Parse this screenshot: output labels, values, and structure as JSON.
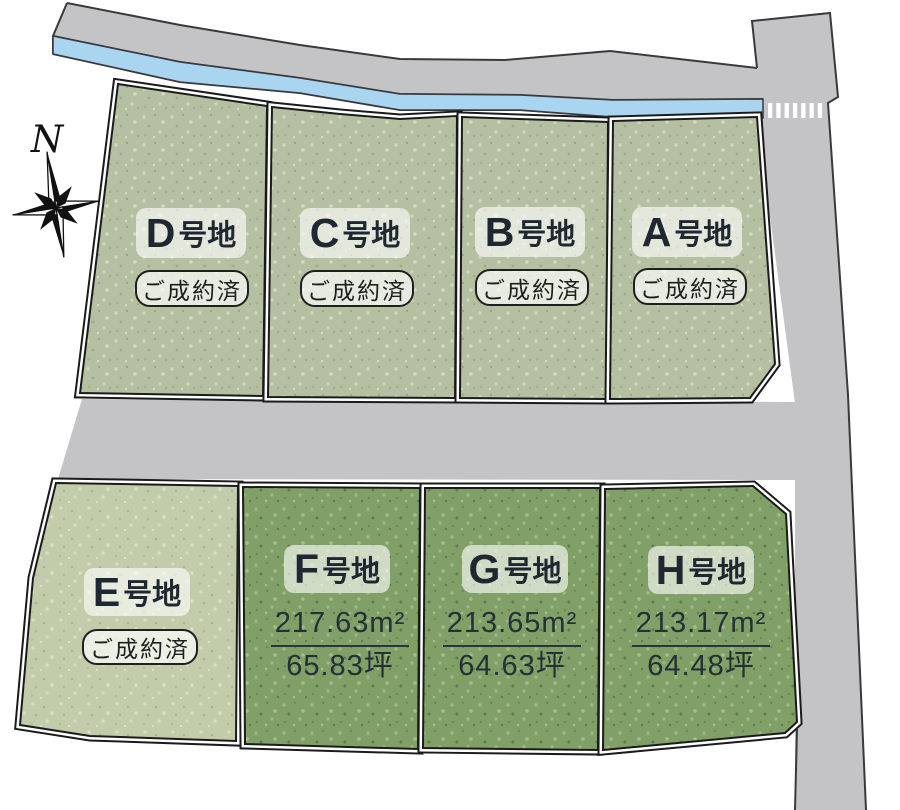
{
  "compass": {
    "label": "N"
  },
  "colors": {
    "road": "#c4c4c6",
    "road_edge": "#3a3a3d",
    "stream": "#aad5f0",
    "crosswalk": "#ffffff",
    "plot_outline": "#1b1b1b",
    "plot_sage": "#b5bfa2",
    "plot_pale": "#c2ccab",
    "plot_green": "#80a067",
    "label_text": "#1f2730"
  },
  "plots": [
    {
      "id": "D",
      "letter": "D",
      "suffix": "号地",
      "badge": "ご成約済",
      "sold": true
    },
    {
      "id": "C",
      "letter": "C",
      "suffix": "号地",
      "badge": "ご成約済",
      "sold": true
    },
    {
      "id": "B",
      "letter": "B",
      "suffix": "号地",
      "badge": "ご成約済",
      "sold": true
    },
    {
      "id": "A",
      "letter": "A",
      "suffix": "号地",
      "badge": "ご成約済",
      "sold": true
    },
    {
      "id": "E",
      "letter": "E",
      "suffix": "号地",
      "badge": "ご成約済",
      "sold": true
    },
    {
      "id": "F",
      "letter": "F",
      "suffix": "号地",
      "area_m2": "217.63m²",
      "area_tsubo": "65.83坪",
      "sold": false
    },
    {
      "id": "G",
      "letter": "G",
      "suffix": "号地",
      "area_m2": "213.65m²",
      "area_tsubo": "64.63坪",
      "sold": false
    },
    {
      "id": "H",
      "letter": "H",
      "suffix": "号地",
      "area_m2": "213.17m²",
      "area_tsubo": "64.48坪",
      "sold": false
    }
  ]
}
